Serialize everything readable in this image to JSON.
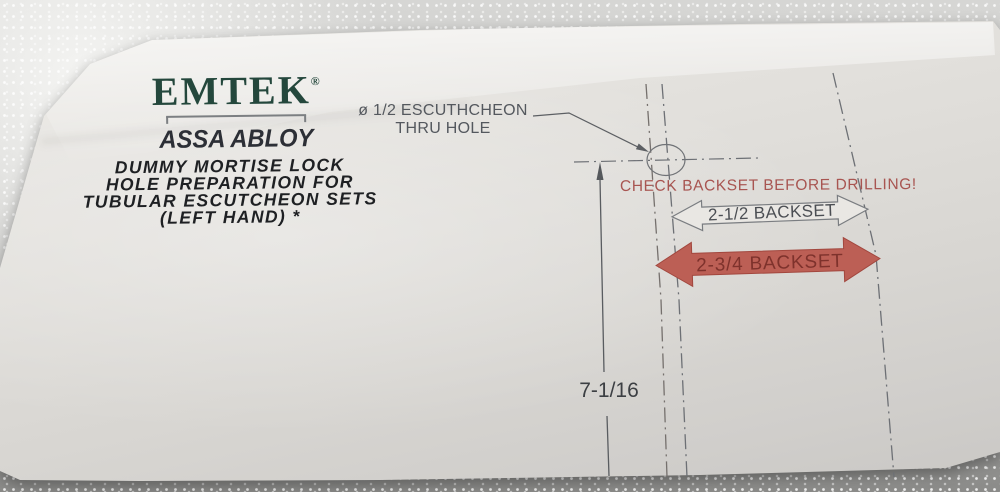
{
  "brand": {
    "logo": "EMTEK",
    "registered": "®",
    "sub_brand": "ASSA ABLOY"
  },
  "title": {
    "lines": [
      "DUMMY MORTISE LOCK",
      "HOLE PREPARATION FOR",
      "TUBULAR ESCUTCHEON SETS",
      "(LEFT HAND) *"
    ]
  },
  "callout": {
    "line1": "ø 1/2 ESCUTHCHEON",
    "line2": "THRU HOLE"
  },
  "warning": {
    "text": "CHECK BACKSET BEFORE DRILLING!"
  },
  "backsets": {
    "white_arrow_label": "2-1/2 BACKSET",
    "red_arrow_label": "2-3/4 BACKSET"
  },
  "dimension": {
    "vertical": "7-1/16"
  },
  "colors": {
    "emtek_green": "#24473c",
    "assa_dark": "#2c2f36",
    "warning_red": "#a85551",
    "arrow_red_fill": "#bc5f55",
    "arrow_red_text": "#7e322c",
    "line_gray": "#6d7075",
    "paper": "#e0dedb"
  }
}
